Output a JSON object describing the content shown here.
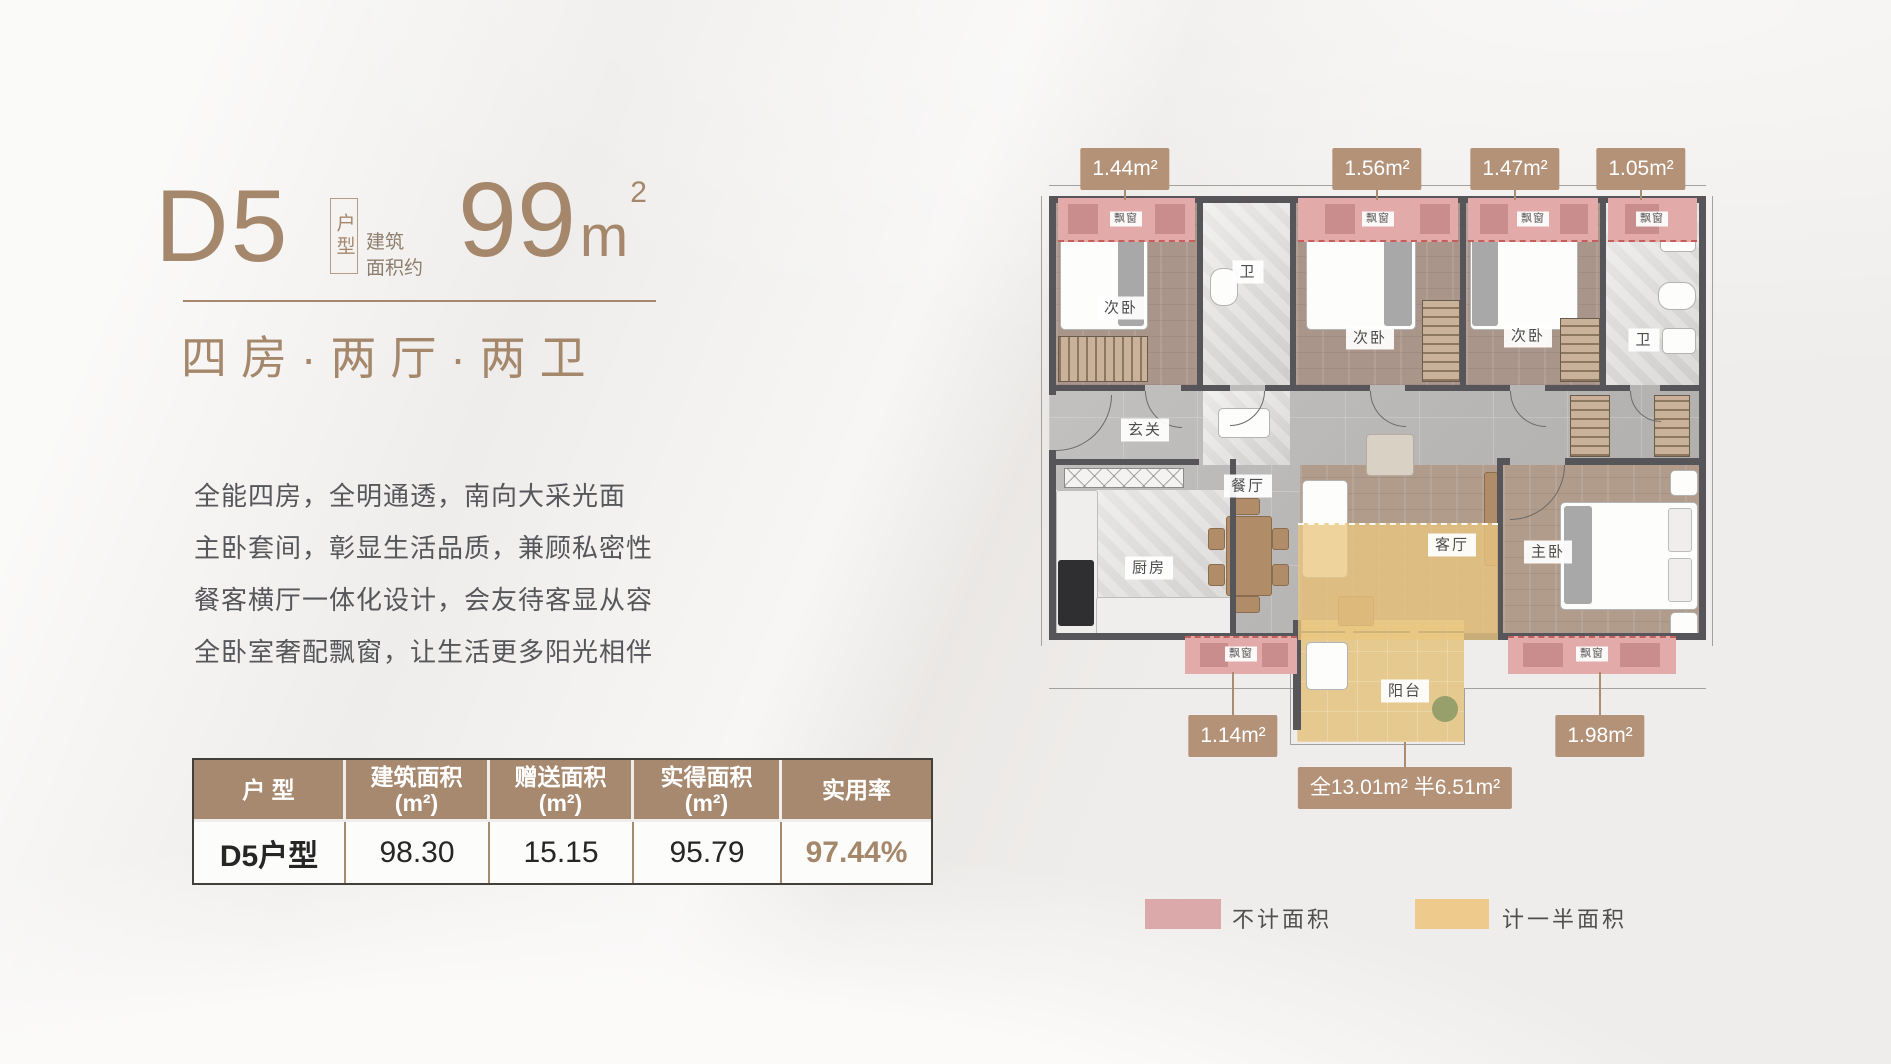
{
  "title": {
    "unit": "D5",
    "unit_tag": "户型",
    "area_prefix_line1": "建筑",
    "area_prefix_line2": "面积约",
    "area_number": "99",
    "area_unit": "m",
    "area_sup": "2",
    "subtitle": "四房·两厅·两卫"
  },
  "description": {
    "line1": "全能四房，全明通透，南向大采光面",
    "line2": "主卧套间，彰显生活品质，兼顾私密性",
    "line3": "餐客横厅一体化设计，会友待客显从容",
    "line4": "全卧室奢配飘窗，让生活更多阳光相伴"
  },
  "table": {
    "col1": {
      "label": "户 型"
    },
    "col2": {
      "label": "建筑面积",
      "unit": "(m²)"
    },
    "col3": {
      "label": "赠送面积",
      "unit": "(m²)"
    },
    "col4": {
      "label": "实得面积",
      "unit": "(m²)"
    },
    "col5": {
      "label": "实用率"
    },
    "row": {
      "name": "D5户型",
      "build_area": "98.30",
      "gift_area": "15.15",
      "actual_area": "95.79",
      "efficiency": "97.44%"
    }
  },
  "plan": {
    "rooms": {
      "bedroom": "次卧",
      "bath": "卫",
      "entry": "玄关",
      "dining": "餐厅",
      "kitchen": "厨房",
      "living": "客厅",
      "master": "主卧",
      "balcony": "阳台",
      "bay_window": "飘窗"
    },
    "badges": {
      "bay1": "1.44m²",
      "bay2": "1.56m²",
      "bay3": "1.47m²",
      "bay4": "1.05m²",
      "bay_kitchen": "1.14m²",
      "bay_master": "1.98m²",
      "balcony_area": "全13.01m² 半6.51m²"
    }
  },
  "legend": {
    "pink_label": "不计面积",
    "yellow_label": "计一半面积",
    "pink_color": "#dca9aa",
    "yellow_color": "#eecb8d"
  },
  "colors": {
    "accent": "#a5876b",
    "wall": "#55555a",
    "badge": "#b39278"
  }
}
